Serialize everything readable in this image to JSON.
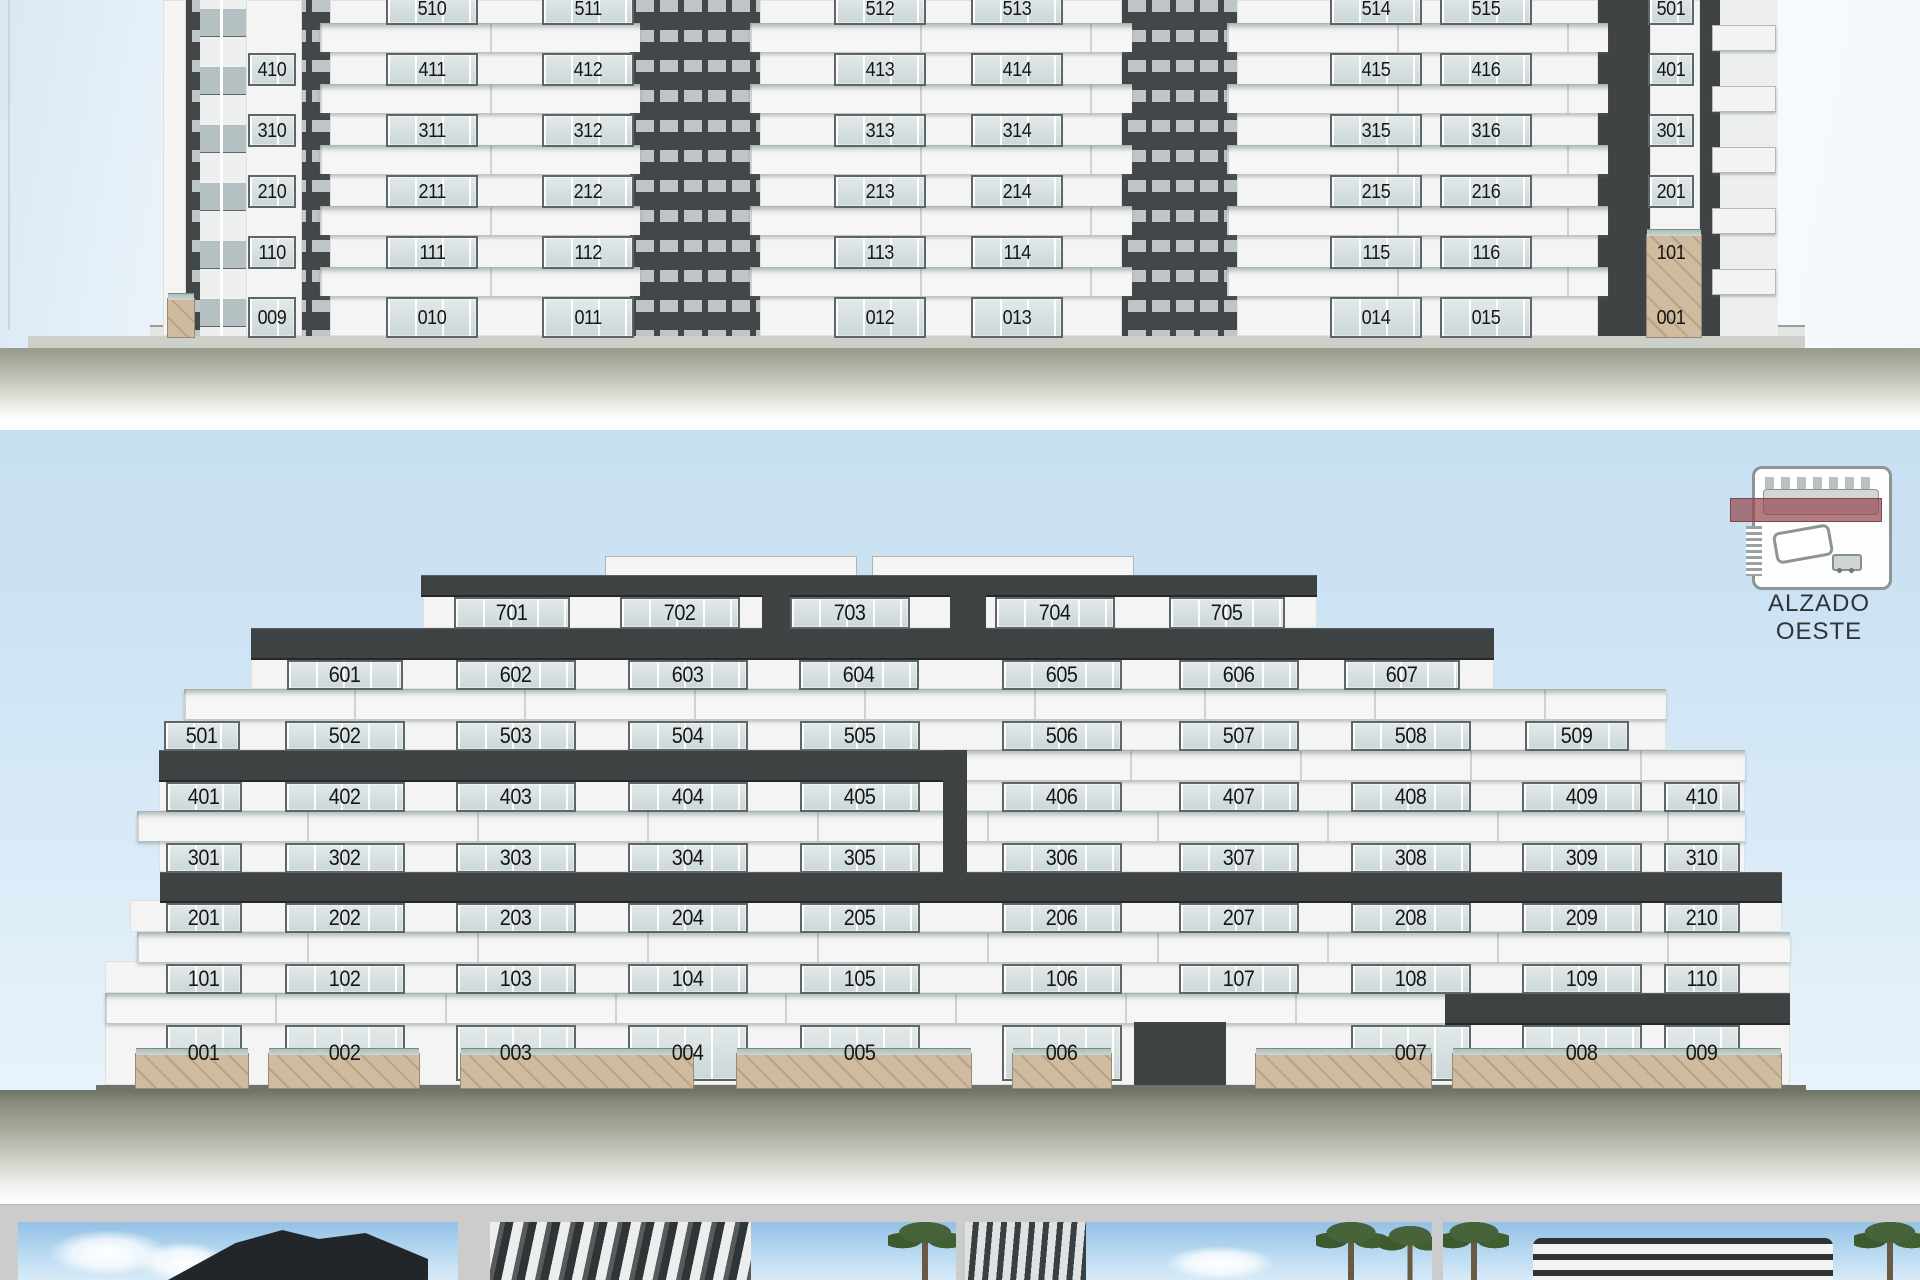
{
  "elevations": {
    "east": {
      "label": "",
      "floors": [
        {
          "units": [
            "510",
            "511",
            "512",
            "513",
            "514",
            "515",
            "501"
          ]
        },
        {
          "units": [
            "410",
            "411",
            "412",
            "413",
            "414",
            "415",
            "416",
            "401"
          ]
        },
        {
          "units": [
            "310",
            "311",
            "312",
            "313",
            "314",
            "315",
            "316",
            "301"
          ]
        },
        {
          "units": [
            "210",
            "211",
            "212",
            "213",
            "214",
            "215",
            "216",
            "201"
          ]
        },
        {
          "units": [
            "110",
            "111",
            "112",
            "113",
            "114",
            "115",
            "116",
            "101"
          ]
        },
        {
          "units": [
            "009",
            "010",
            "011",
            "012",
            "013",
            "014",
            "015",
            "001"
          ]
        }
      ]
    },
    "west": {
      "label": "ALZADO OESTE",
      "floors": [
        {
          "units": [
            "701",
            "702",
            "703",
            "704",
            "705"
          ]
        },
        {
          "units": [
            "601",
            "602",
            "603",
            "604",
            "605",
            "606",
            "607"
          ]
        },
        {
          "units": [
            "501",
            "502",
            "503",
            "504",
            "505",
            "506",
            "507",
            "508",
            "509"
          ]
        },
        {
          "units": [
            "401",
            "402",
            "403",
            "404",
            "405",
            "406",
            "407",
            "408",
            "409",
            "410"
          ]
        },
        {
          "units": [
            "301",
            "302",
            "303",
            "304",
            "305",
            "306",
            "307",
            "308",
            "309",
            "310"
          ]
        },
        {
          "units": [
            "201",
            "202",
            "203",
            "204",
            "205",
            "206",
            "207",
            "208",
            "209",
            "210"
          ]
        },
        {
          "units": [
            "101",
            "102",
            "103",
            "104",
            "105",
            "106",
            "107",
            "108",
            "109",
            "110"
          ]
        },
        {
          "units": [
            "001",
            "002",
            "003",
            "004",
            "005",
            "006",
            "007",
            "008",
            "009"
          ]
        }
      ]
    }
  },
  "icons": {
    "orientation": "site-plan-orientation-icon",
    "orientation_parts": [
      "building-footprint",
      "section-cut-marker",
      "pool-icon",
      "car-icon"
    ]
  },
  "thumbnails": {
    "count": 4
  },
  "colors": {
    "charcoal": "#3E4243",
    "wall_white": "#F3F4F3",
    "glass": "#CCD7D9",
    "rail_glass": "#AFC2BC",
    "sky": "#CDE3F3",
    "stone": "#C8B296",
    "ground": "#8B8E7E",
    "cut_marker_red": "#944A50",
    "thumb_divider_gray": "#CBCCCB"
  }
}
